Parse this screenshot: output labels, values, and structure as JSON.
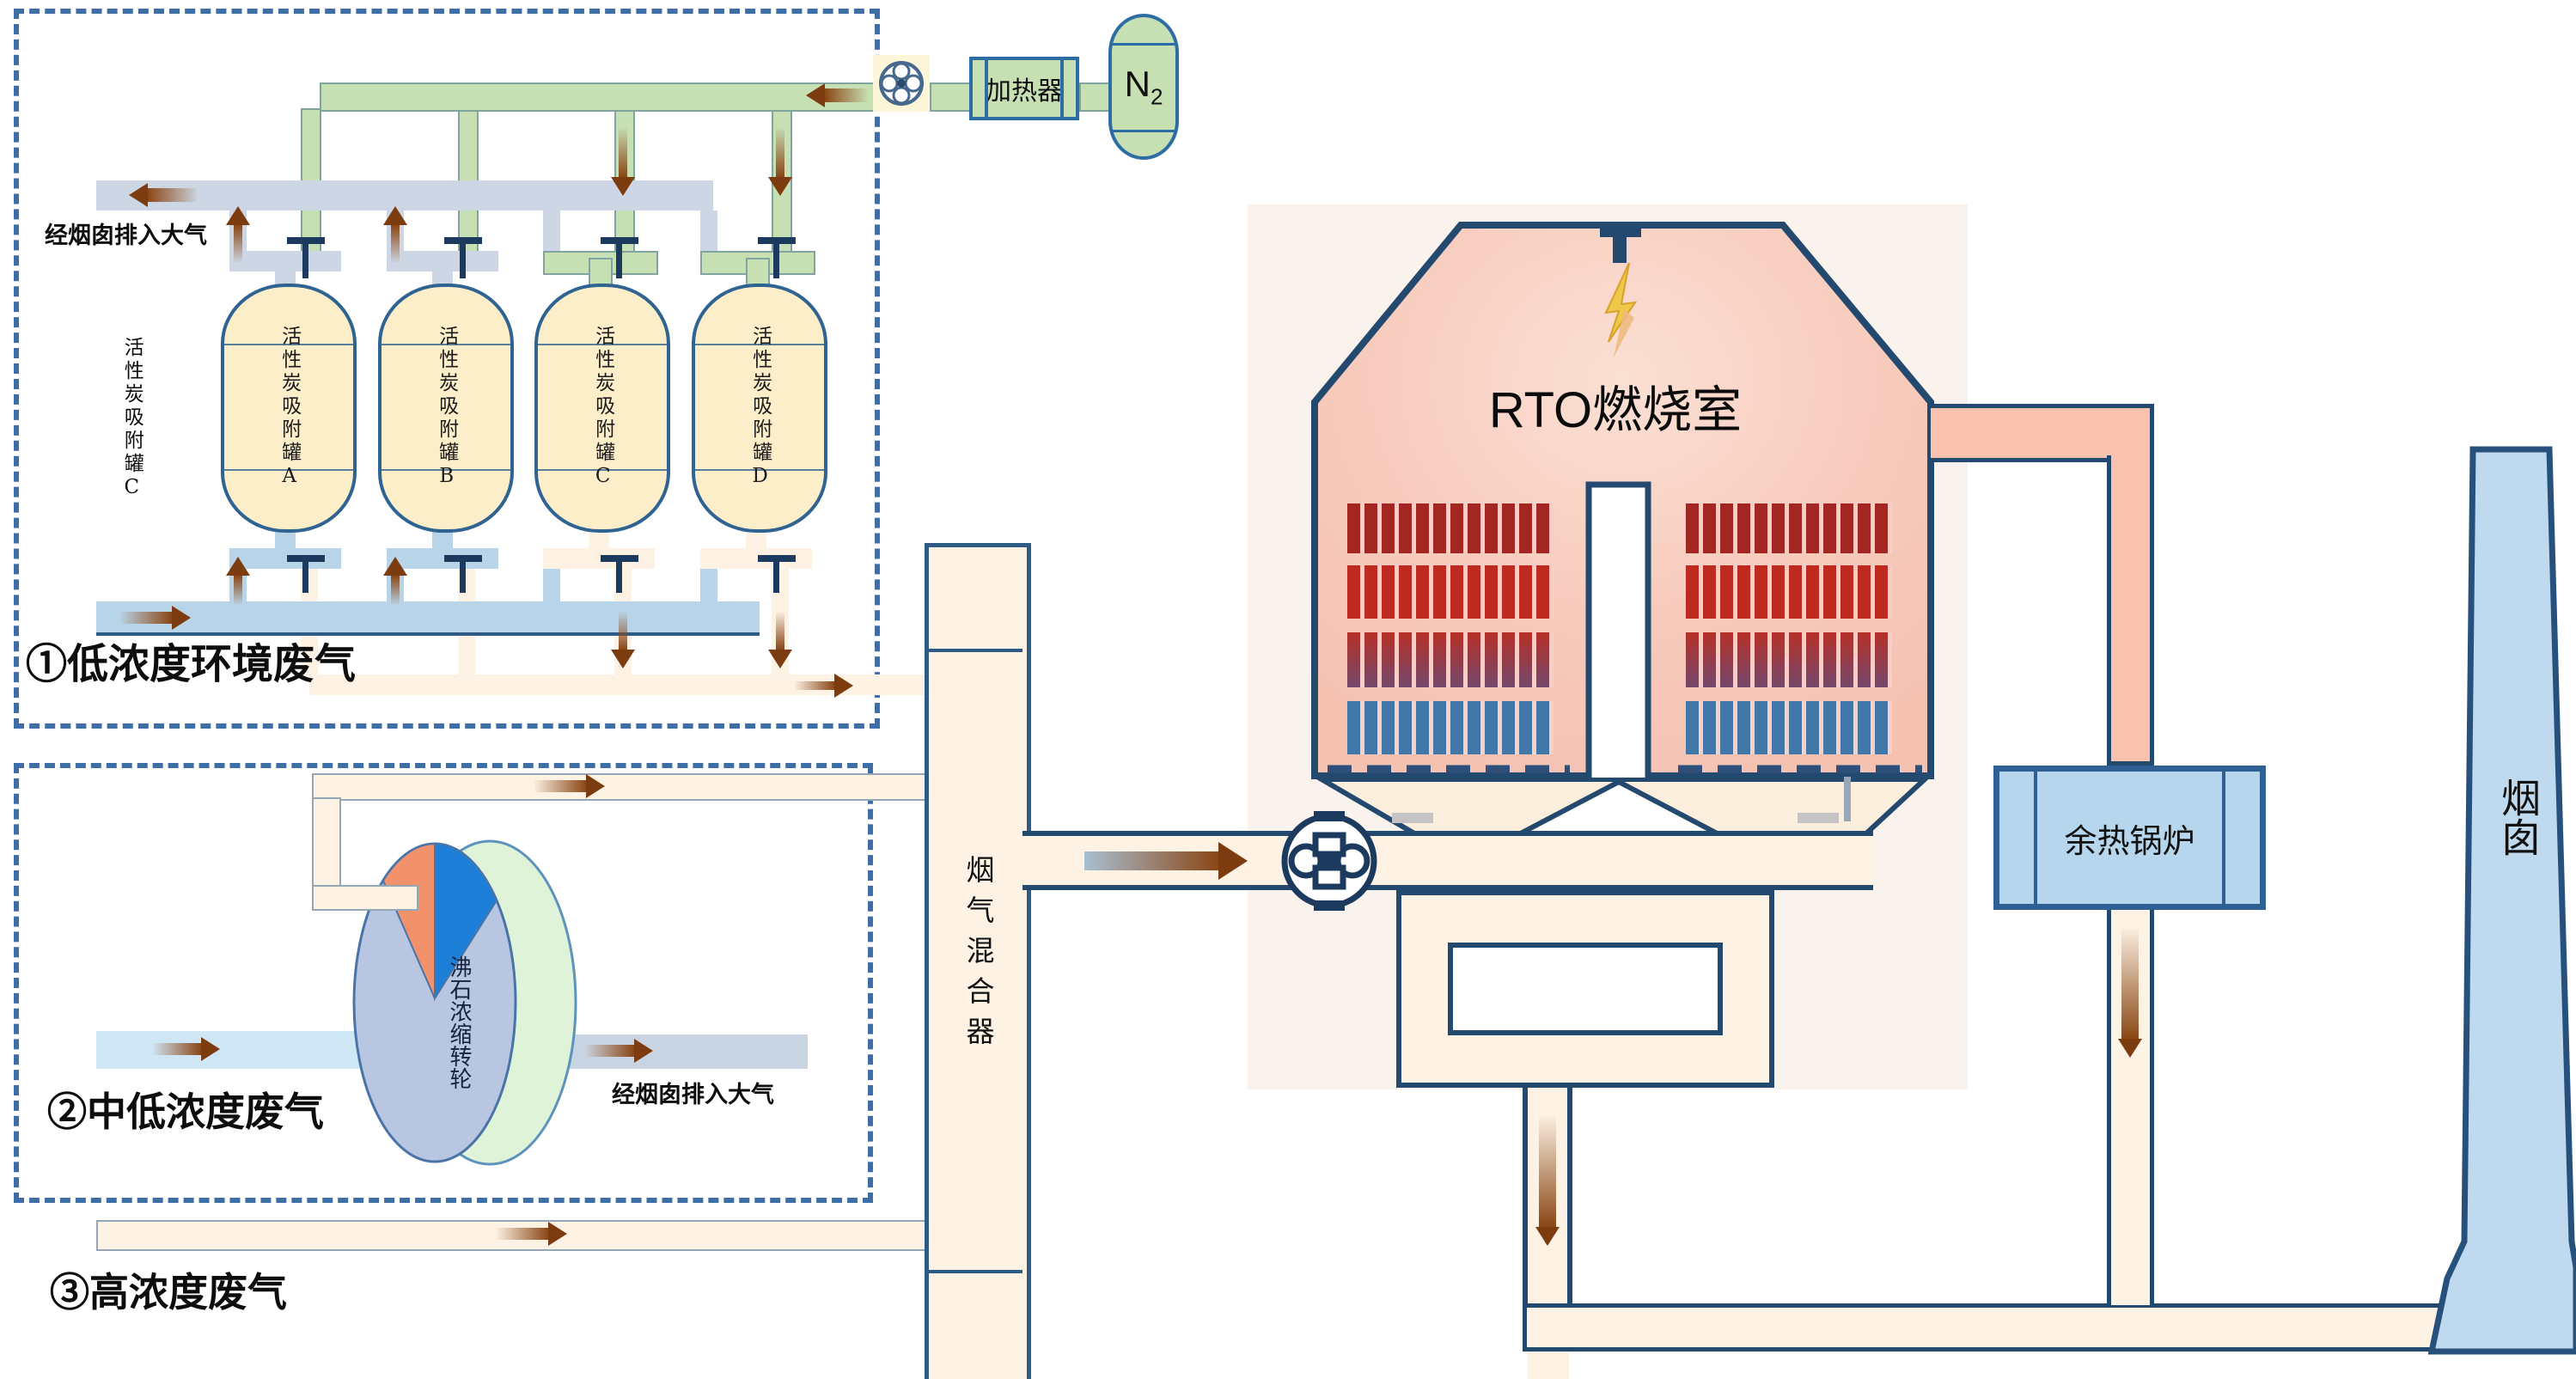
{
  "labels": {
    "region1": "①低浓度环境废气",
    "exhaust_top": "经烟囱排入大气",
    "region2": "②中低浓度废气",
    "exhaust_wheel": "经烟囱排入大气",
    "region3": "③高浓度废气",
    "side_tank": "活性炭吸附罐C",
    "wheel": "沸石浓缩转轮",
    "mixer": "烟气混合器",
    "heater": "加热器",
    "n2_main": "N",
    "n2_sub": "2",
    "rto": "RTO燃烧室",
    "boiler": "余热锅炉",
    "chimney": "烟囱"
  },
  "tanks": [
    {
      "name": "活性炭吸附罐",
      "letter": "A"
    },
    {
      "name": "活性炭吸附罐",
      "letter": "B"
    },
    {
      "name": "活性炭吸附罐",
      "letter": "C"
    },
    {
      "name": "活性炭吸附罐",
      "letter": "D"
    }
  ],
  "colors": {
    "navy_outline": "#24496e",
    "pipe_cream": "#fdf2e4",
    "pipe_blue": "#b8d4e8",
    "pipe_gray": "#ccd6e4",
    "n2_green": "#c6e0b4",
    "tank_fill": "#fceec9",
    "rto_pink": "#f7cabb",
    "bed_red_dark": "#a32622",
    "bed_red": "#bf2a20",
    "bed_blue": "#4177a9",
    "boiler_fill": "#b5d6ec",
    "chimney_fill": "#bfdaee",
    "wheel_front": "#b8c6e2",
    "wheel_side": "#def3d8",
    "wheel_sector_orange": "#f2926c",
    "wheel_sector_blue": "#1e7fd8",
    "arrow_brown": "#8a4716",
    "dashed_box": "#3f6ea6"
  }
}
